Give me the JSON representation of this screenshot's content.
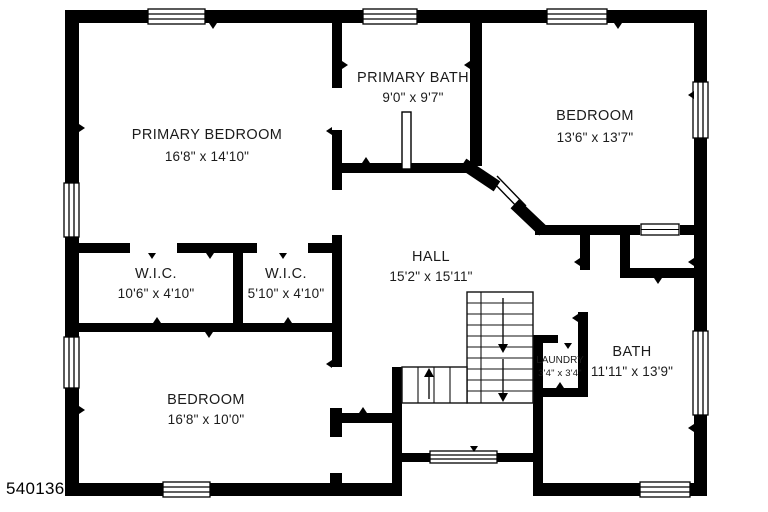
{
  "id_number": "5401362",
  "colors": {
    "wall": "#000000",
    "background": "#ffffff",
    "text": "#1b1b1b"
  },
  "rooms": [
    {
      "name": "PRIMARY BEDROOM",
      "dims": "16'8\" x 14'10\""
    },
    {
      "name": "PRIMARY BATH",
      "dims": "9'0\" x 9'7\""
    },
    {
      "name": "BEDROOM",
      "dims": "13'6\" x 13'7\""
    },
    {
      "name": "W.I.C.",
      "dims": "10'6\" x 4'10\""
    },
    {
      "name": "W.I.C.",
      "dims": "5'10\" x 4'10\""
    },
    {
      "name": "HALL",
      "dims": "15'2\" x 15'11\""
    },
    {
      "name": "LAUNDRY",
      "dims": "3'4\" x 3'4\""
    },
    {
      "name": "BATH",
      "dims": "11'11\" x 13'9\""
    },
    {
      "name": "BEDROOM",
      "dims": "16'8\" x 10'0\""
    }
  ]
}
